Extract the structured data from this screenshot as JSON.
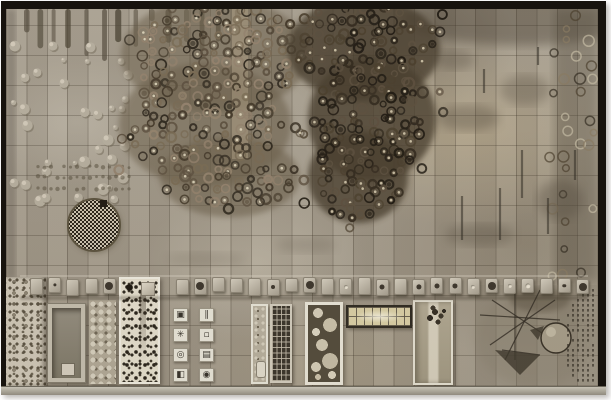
{
  "artwork": {
    "kind": "photo-of-ceramic-relief-tile-mural",
    "palette": {
      "page_bg": "#ffffff",
      "frame": "#17130e",
      "tile_base": "#a7a091",
      "tile_warm": "#b7a98e",
      "grid_line": "rgba(52,44,33,0.30)",
      "drip": "#4b4436",
      "bump_body": "#b8b1a2",
      "bump_shadow": "#6f6858",
      "bump_light": "#dcd5c5",
      "dot_row": "#57503f",
      "disc_dark": "#262118",
      "disc_light": "#cfc7b4",
      "panel_white": "#f2efe5",
      "plinth_light": "#c6c1b4",
      "plinth_dark": "#908b7e",
      "sketch_ink": "#2e2922"
    },
    "left_cluster": {
      "seed": 11,
      "base": "#6a5f4c",
      "base_opacity": 0.55,
      "step": 10.5,
      "x0": 116,
      "x1": 308,
      "y0": 2,
      "y1": 220,
      "ellipses": [
        [
          209,
          46,
          94,
          58
        ],
        [
          199,
          116,
          86,
          62
        ],
        [
          224,
          168,
          70,
          40
        ]
      ],
      "outlier_p": 0.05,
      "strokes": [
        "#2f2920",
        "#443a2c",
        "#5c5040",
        "#7a6c56",
        "#958470"
      ],
      "center_dot": "#e9e0c8",
      "highlight_strip": [
        226,
        0,
        16,
        150
      ]
    },
    "right_cluster": {
      "seed": 23,
      "base": "#473d2f",
      "base_opacity": 0.78,
      "step": 10,
      "x0": 286,
      "x1": 436,
      "y0": 2,
      "y1": 230,
      "ellipses": [
        [
          358,
          40,
          76,
          52
        ],
        [
          366,
          110,
          64,
          62
        ],
        [
          352,
          168,
          50,
          46
        ]
      ],
      "outlier_p": 0.07,
      "strokes": [
        "#211c15",
        "#322a1f",
        "#4a3f2e",
        "#1d1811",
        "#5c5040"
      ],
      "center_dot": "#ded3b8",
      "highlight_strip": null
    },
    "right_edge_rings": {
      "seed": 5,
      "x0": 546,
      "x1": 588,
      "y0": 6,
      "y1": 266,
      "step": 13,
      "p": 0.3,
      "strokes": [
        "#2f2920",
        "#c9c0aa",
        "#4a3f2e",
        "#8a7c64"
      ]
    },
    "drips": {
      "seed": 3,
      "x0": 18,
      "x1": 236
    },
    "bumps": {
      "seed": 9,
      "x0": 6,
      "x1": 124,
      "y0": 40,
      "y1": 202,
      "step": 12.5,
      "p": 0.3
    },
    "dot_rows": {
      "ys": [
        158,
        168,
        180
      ],
      "x0": 32,
      "x1": 128,
      "step": 6.5
    },
    "checkered_disc": {
      "cx": 88,
      "cy": 216,
      "r": 26
    },
    "stains": [
      [
        462,
        109,
        62,
        26,
        0.35
      ],
      [
        519,
        81,
        50,
        30,
        0.3
      ],
      [
        554,
        191,
        46,
        40,
        0.35
      ],
      [
        474,
        226,
        70,
        22,
        0.3
      ],
      [
        449,
        51,
        40,
        20,
        0.3
      ],
      [
        300,
        236,
        60,
        16,
        0.18
      ],
      [
        200,
        250,
        80,
        14,
        0.15
      ]
    ],
    "marks": [
      [
        456,
        187,
        44
      ],
      [
        494,
        179,
        52
      ],
      [
        516,
        141,
        48
      ],
      [
        542,
        189,
        36
      ],
      [
        569,
        141,
        30
      ],
      [
        478,
        60,
        24
      ],
      [
        532,
        38,
        18
      ]
    ],
    "corner_shade": {
      "cx": 514,
      "cy": 10,
      "rx": 118,
      "ry": 26,
      "opacity": 0.38
    },
    "right_shade": {
      "x": 548,
      "y": 0,
      "w": 44,
      "h": 272,
      "opacity": 0.32
    },
    "left_shade": {
      "x": 0,
      "y": 0,
      "w": 10,
      "h": 270,
      "opacity": 0.25
    },
    "sketch": {
      "wash": [
        469,
        276,
        123,
        101
      ],
      "sphere": {
        "cx": 550,
        "cy": 329,
        "r": 15
      },
      "lines": [
        [
          486,
          291,
          554,
          336
        ],
        [
          534,
          281,
          499,
          351
        ],
        [
          509,
          276,
          509,
          351
        ],
        [
          474,
          306,
          554,
          311
        ],
        [
          484,
          336,
          549,
          291
        ],
        [
          496,
          341,
          534,
          346
        ]
      ],
      "wedges": [
        "M489,341 L534,346 L514,366 Z",
        "M524,321 L538,317 L532,331 Z"
      ],
      "blotch": {
        "cx": 534,
        "cy": 291,
        "rx": 30,
        "ry": 12
      },
      "dot_band": {
        "cx": 634,
        "cy": 331,
        "r_in": 42,
        "r_out": 78,
        "seed": 17
      }
    },
    "knob_row": {
      "seed": 31,
      "count": 31,
      "x0": 24,
      "step": 18.2,
      "y": 269,
      "w": 13,
      "h": 16,
      "skip": [
        106,
        158
      ]
    },
    "icon_tiles": [
      {
        "name": "framed-square-icon",
        "glyph": "▣"
      },
      {
        "name": "double-bars-icon",
        "glyph": "∥"
      },
      {
        "name": "asterisk-icon",
        "glyph": "✳"
      },
      {
        "name": "small-square-icon",
        "glyph": "▫"
      },
      {
        "name": "bullseye-icon",
        "glyph": "◎"
      },
      {
        "name": "hatched-square-icon",
        "glyph": "▤"
      },
      {
        "name": "half-filled-square-icon",
        "glyph": "◧"
      },
      {
        "name": "dot-circle-icon",
        "glyph": "◉"
      }
    ]
  }
}
